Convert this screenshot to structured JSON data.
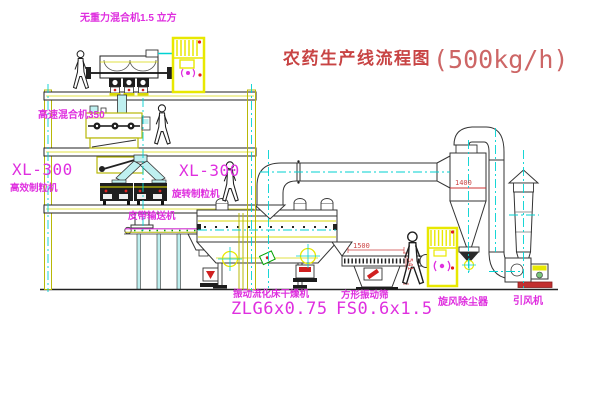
{
  "title": {
    "text": "农药生产线流程图",
    "capacity": "(500kg/h)"
  },
  "equipment_labels": {
    "gravity_mixer": "无重力混合机1.5 立方",
    "high_speed_mixer": "高速混合机350",
    "granulator_left_model": "XL-300",
    "granulator_left_name": "高效制粒机",
    "granulator_mid_model": "XL-300",
    "granulator_mid_name": "旋转制粒机",
    "belt_conveyor": "皮带输送机",
    "fluid_bed_dryer_name": "振动流化床干燥机",
    "fluid_bed_dryer_model": "ZLG6x0.75",
    "vibrating_screen_name": "方形振动筛",
    "vibrating_screen_model": "FS0.6x1.5",
    "cyclone": "旋风除尘器",
    "induced_draft_fan": "引风机"
  },
  "dimensions": {
    "screen_length": "1500",
    "screen_height": "541",
    "cyclone_marking": "1400"
  },
  "colors": {
    "line_yellow": "#d8d808",
    "cabinet_yellow": "#e8e800",
    "line_cyan": "#00d2d2",
    "pipe_fill_cyan": "#bff0f0",
    "label_magenta": "#df2fdf",
    "title_red": "#c84444",
    "dimension_red": "#cc4444",
    "status_red_dot": "#e02020",
    "line_black": "#222222"
  }
}
